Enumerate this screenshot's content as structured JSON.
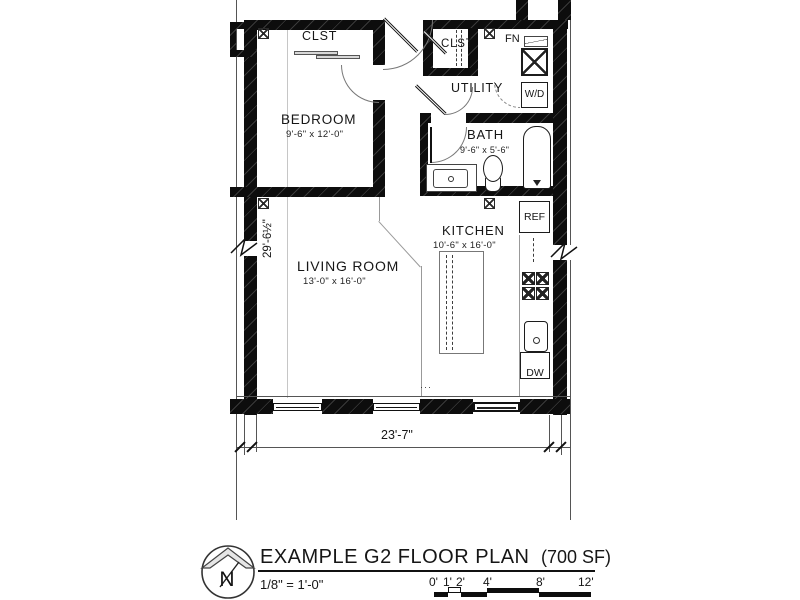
{
  "plan": {
    "rooms": {
      "bedroom": {
        "name": "BEDROOM",
        "dims": "9'-6\" x 12'-0\""
      },
      "living": {
        "name": "LIVING ROOM",
        "dims": "13'-0\" x 16'-0\""
      },
      "kitchen": {
        "name": "KITCHEN",
        "dims": "10'-6\" x 16'-0\""
      },
      "bath": {
        "name": "BATH",
        "dims": "9'-6\" x 5'-6\""
      },
      "utility": {
        "name": "UTILITY"
      },
      "closet1": {
        "name": "CLST"
      },
      "closet2": {
        "name": "CLST"
      }
    },
    "fixtures": {
      "furnace": "FN",
      "washer_dryer": "W/D",
      "fridge": "REF",
      "dishwasher": "DW"
    },
    "dimensions": {
      "overall_width": "23'-7\"",
      "overall_height": "29'-6½\""
    }
  },
  "titleblock": {
    "title": "EXAMPLE G2 FLOOR PLAN",
    "area": "(700 SF)",
    "scale": "1/8\" = 1'-0\"",
    "north_label": "N",
    "scalebar_labels": [
      "0'",
      "1'",
      "2'",
      "4'",
      "8'",
      "12'"
    ]
  }
}
